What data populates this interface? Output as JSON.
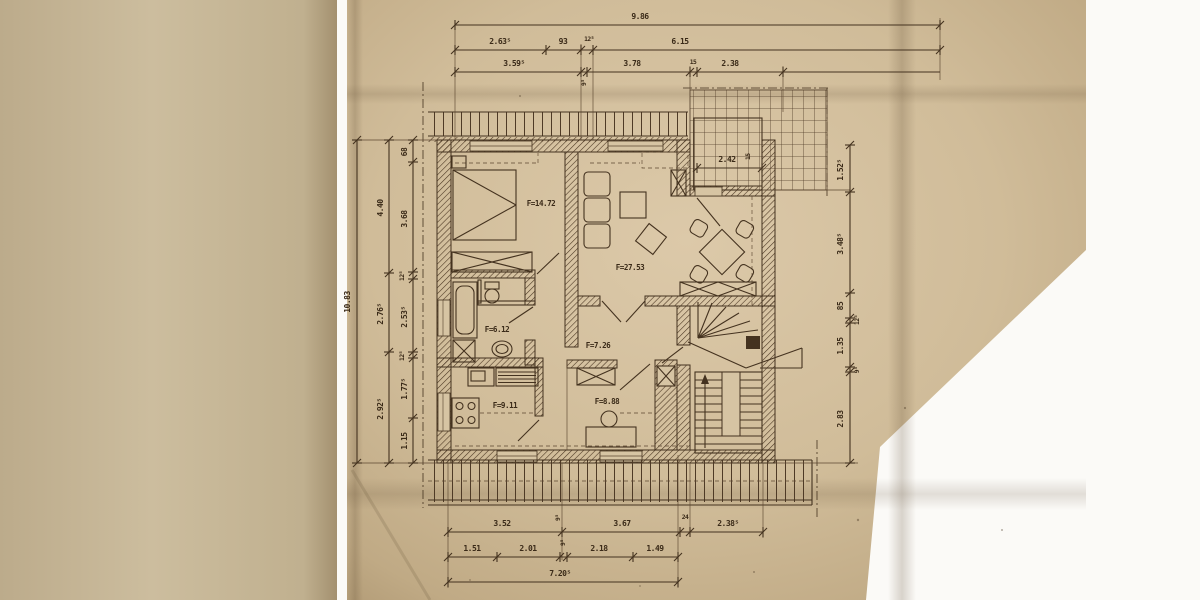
{
  "document": {
    "kind": "scanned attic floor plan drawing",
    "paper_color": "#d2bf9e",
    "ink_color": "#44321f"
  },
  "rooms": {
    "bedroom": "F=14.72",
    "living": "F=27.53",
    "bath": "F=6.12",
    "hall": "F=7.26",
    "kitchen": "F=9.11",
    "study": "F=8.88"
  },
  "dims": {
    "top1": "9.86",
    "top2": [
      "2.63⁵",
      "93",
      "12⁵",
      "6.15"
    ],
    "top3": [
      "3.59⁵",
      "9⁵",
      "3.78",
      "15",
      "2.38"
    ],
    "left_outer": "10.83",
    "left_mid": [
      "4.40",
      "2.76⁵",
      "2.92⁵"
    ],
    "left_inner": [
      "68",
      "3.68",
      "12⁵",
      "2.53⁵",
      "12⁵",
      "1.77⁵",
      "1.15"
    ],
    "right": [
      "1.52⁵",
      "3.48⁵",
      "85",
      "12⁵",
      "1.35",
      "9⁵",
      "2.83"
    ],
    "bottom1": [
      "3.52",
      "9⁵",
      "3.67",
      "24",
      "2.38⁵"
    ],
    "bottom2": [
      "1.51",
      "2.01",
      "9⁵",
      "2.18",
      "1.49"
    ],
    "bottom3": "7.20⁵",
    "balcony": "2.42",
    "balcony_side": "15"
  }
}
